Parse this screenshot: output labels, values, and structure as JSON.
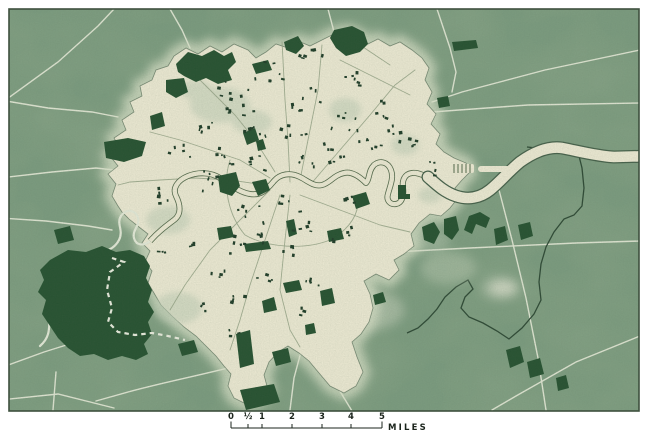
{
  "scalebar": {
    "ticks": [
      "0",
      "½",
      "1",
      "2",
      "3",
      "4",
      "5"
    ],
    "unit": "MILES"
  },
  "colors": {
    "page_bg": "#ffffff",
    "countryside": "#8fa98c",
    "urban": "#f6f1db",
    "urban_shade": "#c8d4bd",
    "halo": "#e3e9d0",
    "park": "#24502f",
    "road_rural": "#eef1df",
    "road_urban": "#9fab8e",
    "river_upstream": "#edf1e0",
    "river_fill": "#f6f1db",
    "river_channel_outline": "#55694b",
    "river_east_outline": "#46604a",
    "boundary_dark": "#2c4733",
    "boundary_dashed": "#f2f3e6",
    "plate_border": "#3e503e",
    "scalebar_text": "#1b241c",
    "building": "#1d3a26"
  }
}
